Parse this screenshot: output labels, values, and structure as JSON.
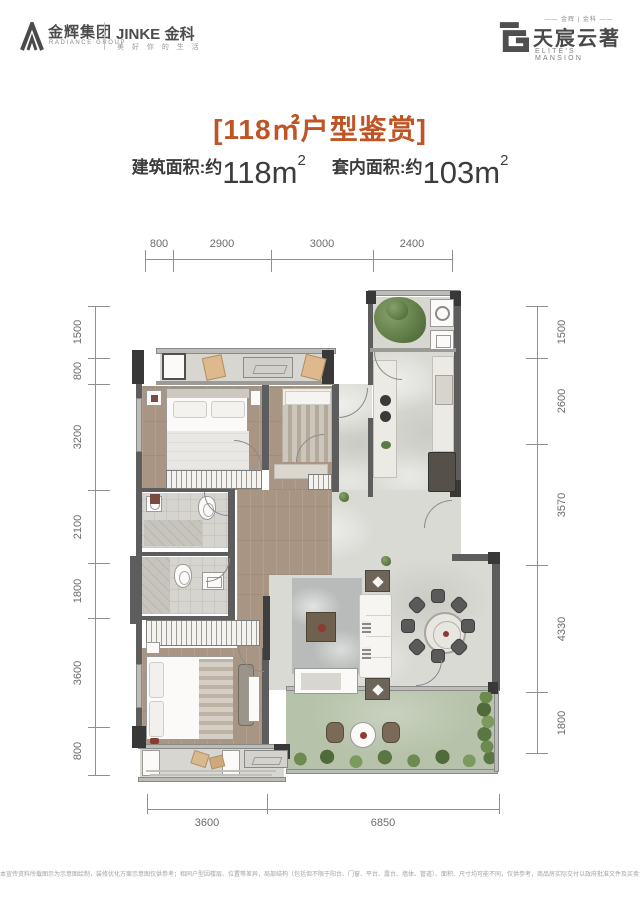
{
  "header": {
    "radiance": {
      "name_cn": "金辉集团",
      "name_en": "RADIANCE GROUP"
    },
    "jinke": {
      "name": "JINKE",
      "name_cn": "金科",
      "slogan": "美 好 你 的 生 活"
    },
    "estate": {
      "brands": "—— 金辉 | 金科 ——",
      "name_cn": "天宸云著",
      "name_en": "ELITE'S MANSION"
    }
  },
  "title": "[118㎡户型鉴赏]",
  "areas": {
    "built_label": "建筑面积:约",
    "built_value": "118m",
    "built_sup": "2",
    "inner_label": "套内面积:约",
    "inner_value": "103m",
    "inner_sup": "2"
  },
  "plan": {
    "dims": {
      "top": [
        "800",
        "2900",
        "3000",
        "2400"
      ],
      "left": [
        "1500",
        "800",
        "3200",
        "2100",
        "1800",
        "3600",
        "800"
      ],
      "right": [
        "1500",
        "2600",
        "3570",
        "4330",
        "1800"
      ],
      "bottom": [
        "3600",
        "6850"
      ]
    }
  },
  "colors": {
    "accent_orange": "#bf5425",
    "wall_gray": "#5d5d5d",
    "balcony_green": "#b6c2a9",
    "wood_floor": "#a89583",
    "accent_red": "#8d3a30"
  },
  "footer": {
    "disclaimer": "本宣传资料所载图示为示意图绘制，装修优化方案示意图仅供参考；相同户型因楼层、位置等差异，局部结构（包括但不限于阳台、门窗、平台、露台、墙体、管道）、面积、尺寸均可能不同，仅供参考，商品房实际交付以政府批准文件及买卖合同约定为准。"
  }
}
